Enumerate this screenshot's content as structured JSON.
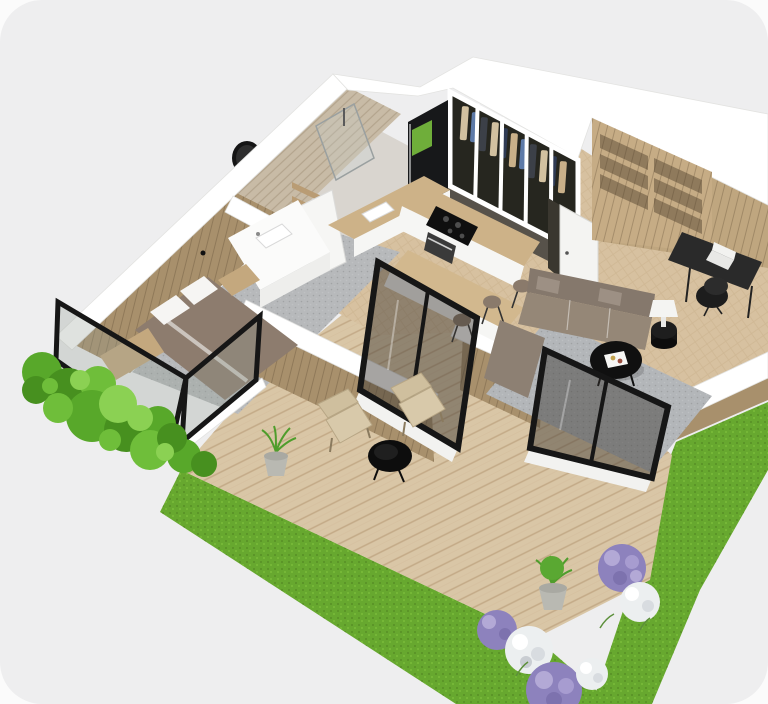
{
  "viewport": {
    "kind": "3d-floorplan-render",
    "camera": "elevated isometric, rotated plan view",
    "canvas_shape": "rounded-rectangle",
    "background_color": "#eeeeef",
    "page_color": "#fbfbfb",
    "visible_text": "none"
  },
  "palette": {
    "canvas_gray": "#eeeeef",
    "wall_top_white": "#ffffff",
    "wall_wood": "#a8906c",
    "wall_stone": "#c8bba6",
    "floor_wood_herringbone": "#d7c1a0",
    "bedroom_carpet_gray": "#b7b9bb",
    "living_rug_gray": "#b3b6b9",
    "deck_wood": "#d9c6a6",
    "grass_green": "#67a82f",
    "hedge_green": "#58a82a",
    "lavender_purple": "#8d82bd",
    "lavender_white": "#eceff0",
    "window_frame_black": "#161616",
    "sofa_taupe": "#8d8073",
    "bed_duvet_taupe": "#8d7c6e",
    "counter_white": "#f6f6f4",
    "wood_furniture": "#c4a87e",
    "accent_green_fridge_panel": "#6fae3a"
  },
  "rooms": [
    {
      "name": "bathroom",
      "position": "top-left",
      "items": [
        "stone accent wall",
        "round black wall mirror",
        "walk-in glass shower",
        "white vanity with sink",
        "wood wall shelves",
        "open white door"
      ]
    },
    {
      "name": "bedroom",
      "position": "left",
      "items": [
        "double bed with taupe duvet",
        "two white pillows",
        "wood bench at foot of bed",
        "wood nightstand",
        "gray carpet floor",
        "black-framed corner window",
        "wall sconce"
      ]
    },
    {
      "name": "walk-in-closet",
      "position": "top-center",
      "items": [
        "glass wardrobe wall with white mullions",
        "hanging clothes beige blue dark",
        "black refrigerator with green panel",
        "open white entry door"
      ]
    },
    {
      "name": "kitchen",
      "position": "center",
      "items": [
        "L-shaped white cabinets with wood counter",
        "black induction cooktop",
        "oven",
        "white sink",
        "wood bar counter",
        "three bar stools"
      ]
    },
    {
      "name": "living-room",
      "position": "center-right",
      "items": [
        "L-shaped taupe sectional sofa",
        "gray area rug",
        "round black coffee table with white tray",
        "black cylinder side table",
        "white table lamp",
        "sliding glass door to deck"
      ]
    },
    {
      "name": "home-office",
      "position": "top-right",
      "items": [
        "wood shelving unit",
        "black desk with hairpin legs",
        "white laptop",
        "black office chair"
      ]
    }
  ],
  "exterior": {
    "deck": "large diagonal-plank wood terrace, lower half",
    "deck_items": [
      "two wicker armchairs",
      "round black side table",
      "potted grass near bedroom wall",
      "potted grass at deck edge"
    ],
    "landscaping": [
      "boxwood hedge along upper-left facade",
      "bright lawn strip along lower-left deck edge",
      "lawn strip along right facade",
      "lavender bushes purple and white at bottom-right corner"
    ],
    "glazing": [
      "bedroom corner window",
      "kitchen sliding door",
      "living room sliding door"
    ]
  }
}
